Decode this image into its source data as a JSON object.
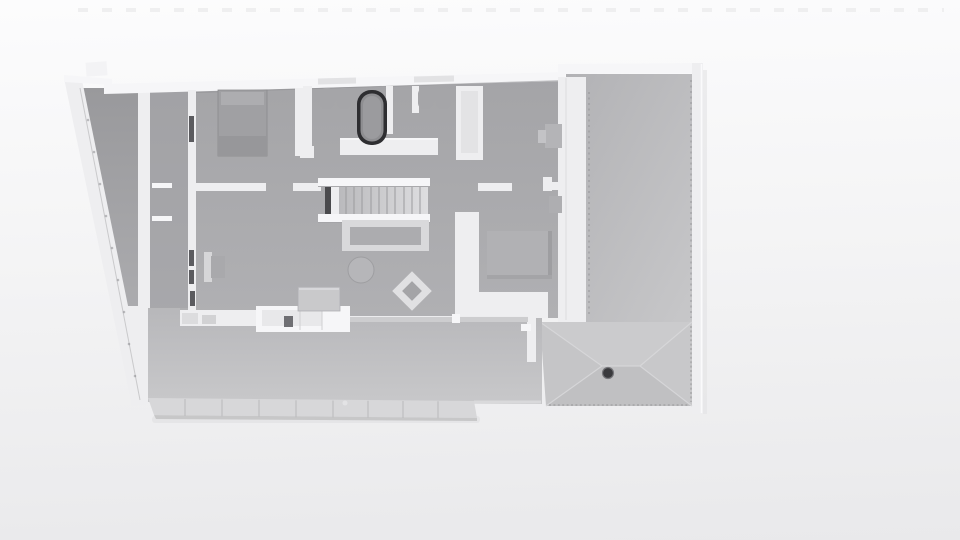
{
  "viewport": {
    "kind": "architectural-3d-render",
    "view": "top-down orthographic floor plan",
    "render_style": "monochrome clay render, no textures, no text labels"
  },
  "colors": {
    "bg_top": "#fcfcfd",
    "bg_mid": "#f4f4f5",
    "bg_bottom": "#e9e9eb",
    "wall": "#eeeef0",
    "wall_bright": "#f6f6f8",
    "wall_shade": "#d8d8da",
    "floor_a": "#a4a4a7",
    "floor_b": "#b0b0b3",
    "deck_a": "#b7b7ba",
    "deck_b": "#c8c8ca",
    "fascia": "#d7d7d9",
    "garage_a": "#b2b2b5",
    "garage_b": "#c7c7c9",
    "roof_top": "#cbcbcd",
    "roof_bottom": "#c0c0c2",
    "roof_left": "#c5c5c7",
    "roof_right": "#c8c8ca",
    "ridge": "#d7d7d9",
    "furniture_gray": "#b1b1b4",
    "furniture_dark": "#a0a0a3",
    "tub_rim": "#2e2e31",
    "tub_inner": "#8e8e91",
    "chimney": "#3a3a3d",
    "dot": "#8a8a8e",
    "slit": "#3b3b3e",
    "shadow": "#8c8c90",
    "stair_well": "#4a4a4d"
  },
  "scene": {
    "rooms": [
      "bedroom-top-left",
      "bathroom-with-tub",
      "bathroom-2",
      "bedroom-right",
      "hallway",
      "living-room",
      "study",
      "side-corridor",
      "garage-court",
      "deck-terrace"
    ],
    "furniture": [
      "double-bed",
      "bathtub",
      "wall-sink",
      "wall-sink",
      "wall-sink",
      "wall-sink",
      "staircase",
      "sofa",
      "round-coffee-table",
      "lounge-chair-diamond",
      "study-desk",
      "sideboard",
      "kitchen-counter",
      "bed-right-room",
      "wall-desk",
      "side-table"
    ],
    "roof": {
      "type": "hip",
      "chimney_count": 1
    },
    "deck_fascia_segments": 9,
    "stair_treads": 10
  }
}
